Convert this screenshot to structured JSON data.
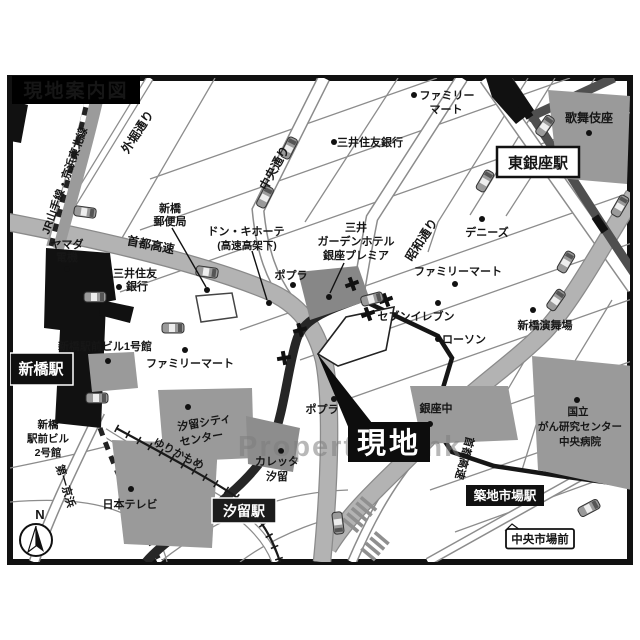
{
  "title": "現地案内図",
  "watermark": "Property Bank",
  "compass": {
    "n": "N"
  },
  "site": {
    "label": "現地"
  },
  "stations": {
    "shimbashi": "新橋駅",
    "higashi_ginza": "東銀座駅",
    "shiodome": "汐留駅",
    "tsukiji_shijo": "築地市場駅",
    "chuo_shijo_mae": "中央市場前"
  },
  "roads": {
    "jr_line": "JR山手線・京浜東北線",
    "sotobori_dori": "外堀通り",
    "chuo_dori": "中央通り",
    "showa_dori": "昭和通り",
    "shuto_expressway": "首都高速",
    "shuto_expressway_2": "首都高速",
    "daiichi_keihin": "第一京浜",
    "yurikamome": "ゆりかもめ"
  },
  "pois": {
    "mitsui_bank_ginza": "三井住友銀行",
    "famima_top": [
      "ファミリー",
      "マート"
    ],
    "kabukiza": "歌舞伎座",
    "post_office": [
      "新橋",
      "郵便局"
    ],
    "donki": [
      "ドン・キホーテ",
      "(高速高架下)"
    ],
    "mitsui_garden": [
      "三井",
      "ガーデンホテル",
      "銀座プレミア"
    ],
    "dennys": "デニーズ",
    "famima_right": "ファミリーマート",
    "seven_eleven": "セブンイレブン",
    "lawson": "ローソン",
    "enbujo": "新橋演舞場",
    "yamada": [
      "ヤマダ",
      "電機"
    ],
    "mitsui_bank_shimbashi": [
      "三井住友",
      "銀行"
    ],
    "ekimae_bldg1": "新橋駅前ビル1号館",
    "famima_left": "ファミリーマート",
    "poplar1": "ポプラ",
    "poplar2": "ポプラ",
    "shiodome_city": [
      "汐留シティ",
      "センター"
    ],
    "caretta": [
      "カレッタ",
      "汐留"
    ],
    "ekimae_bldg2": [
      "新橋",
      "駅前ビル",
      "2号館"
    ],
    "nittele": "日本テレビ",
    "ginza_chu": "銀座中",
    "ncc": [
      "国立",
      "がん研究センター",
      "中央病院"
    ]
  },
  "colors": {
    "expressway": "#b3b3b3",
    "rail_gray": "#9b9b9b",
    "subway_dark": "#4f4f4f",
    "building": "#9a9a9a",
    "black": "#111111"
  }
}
